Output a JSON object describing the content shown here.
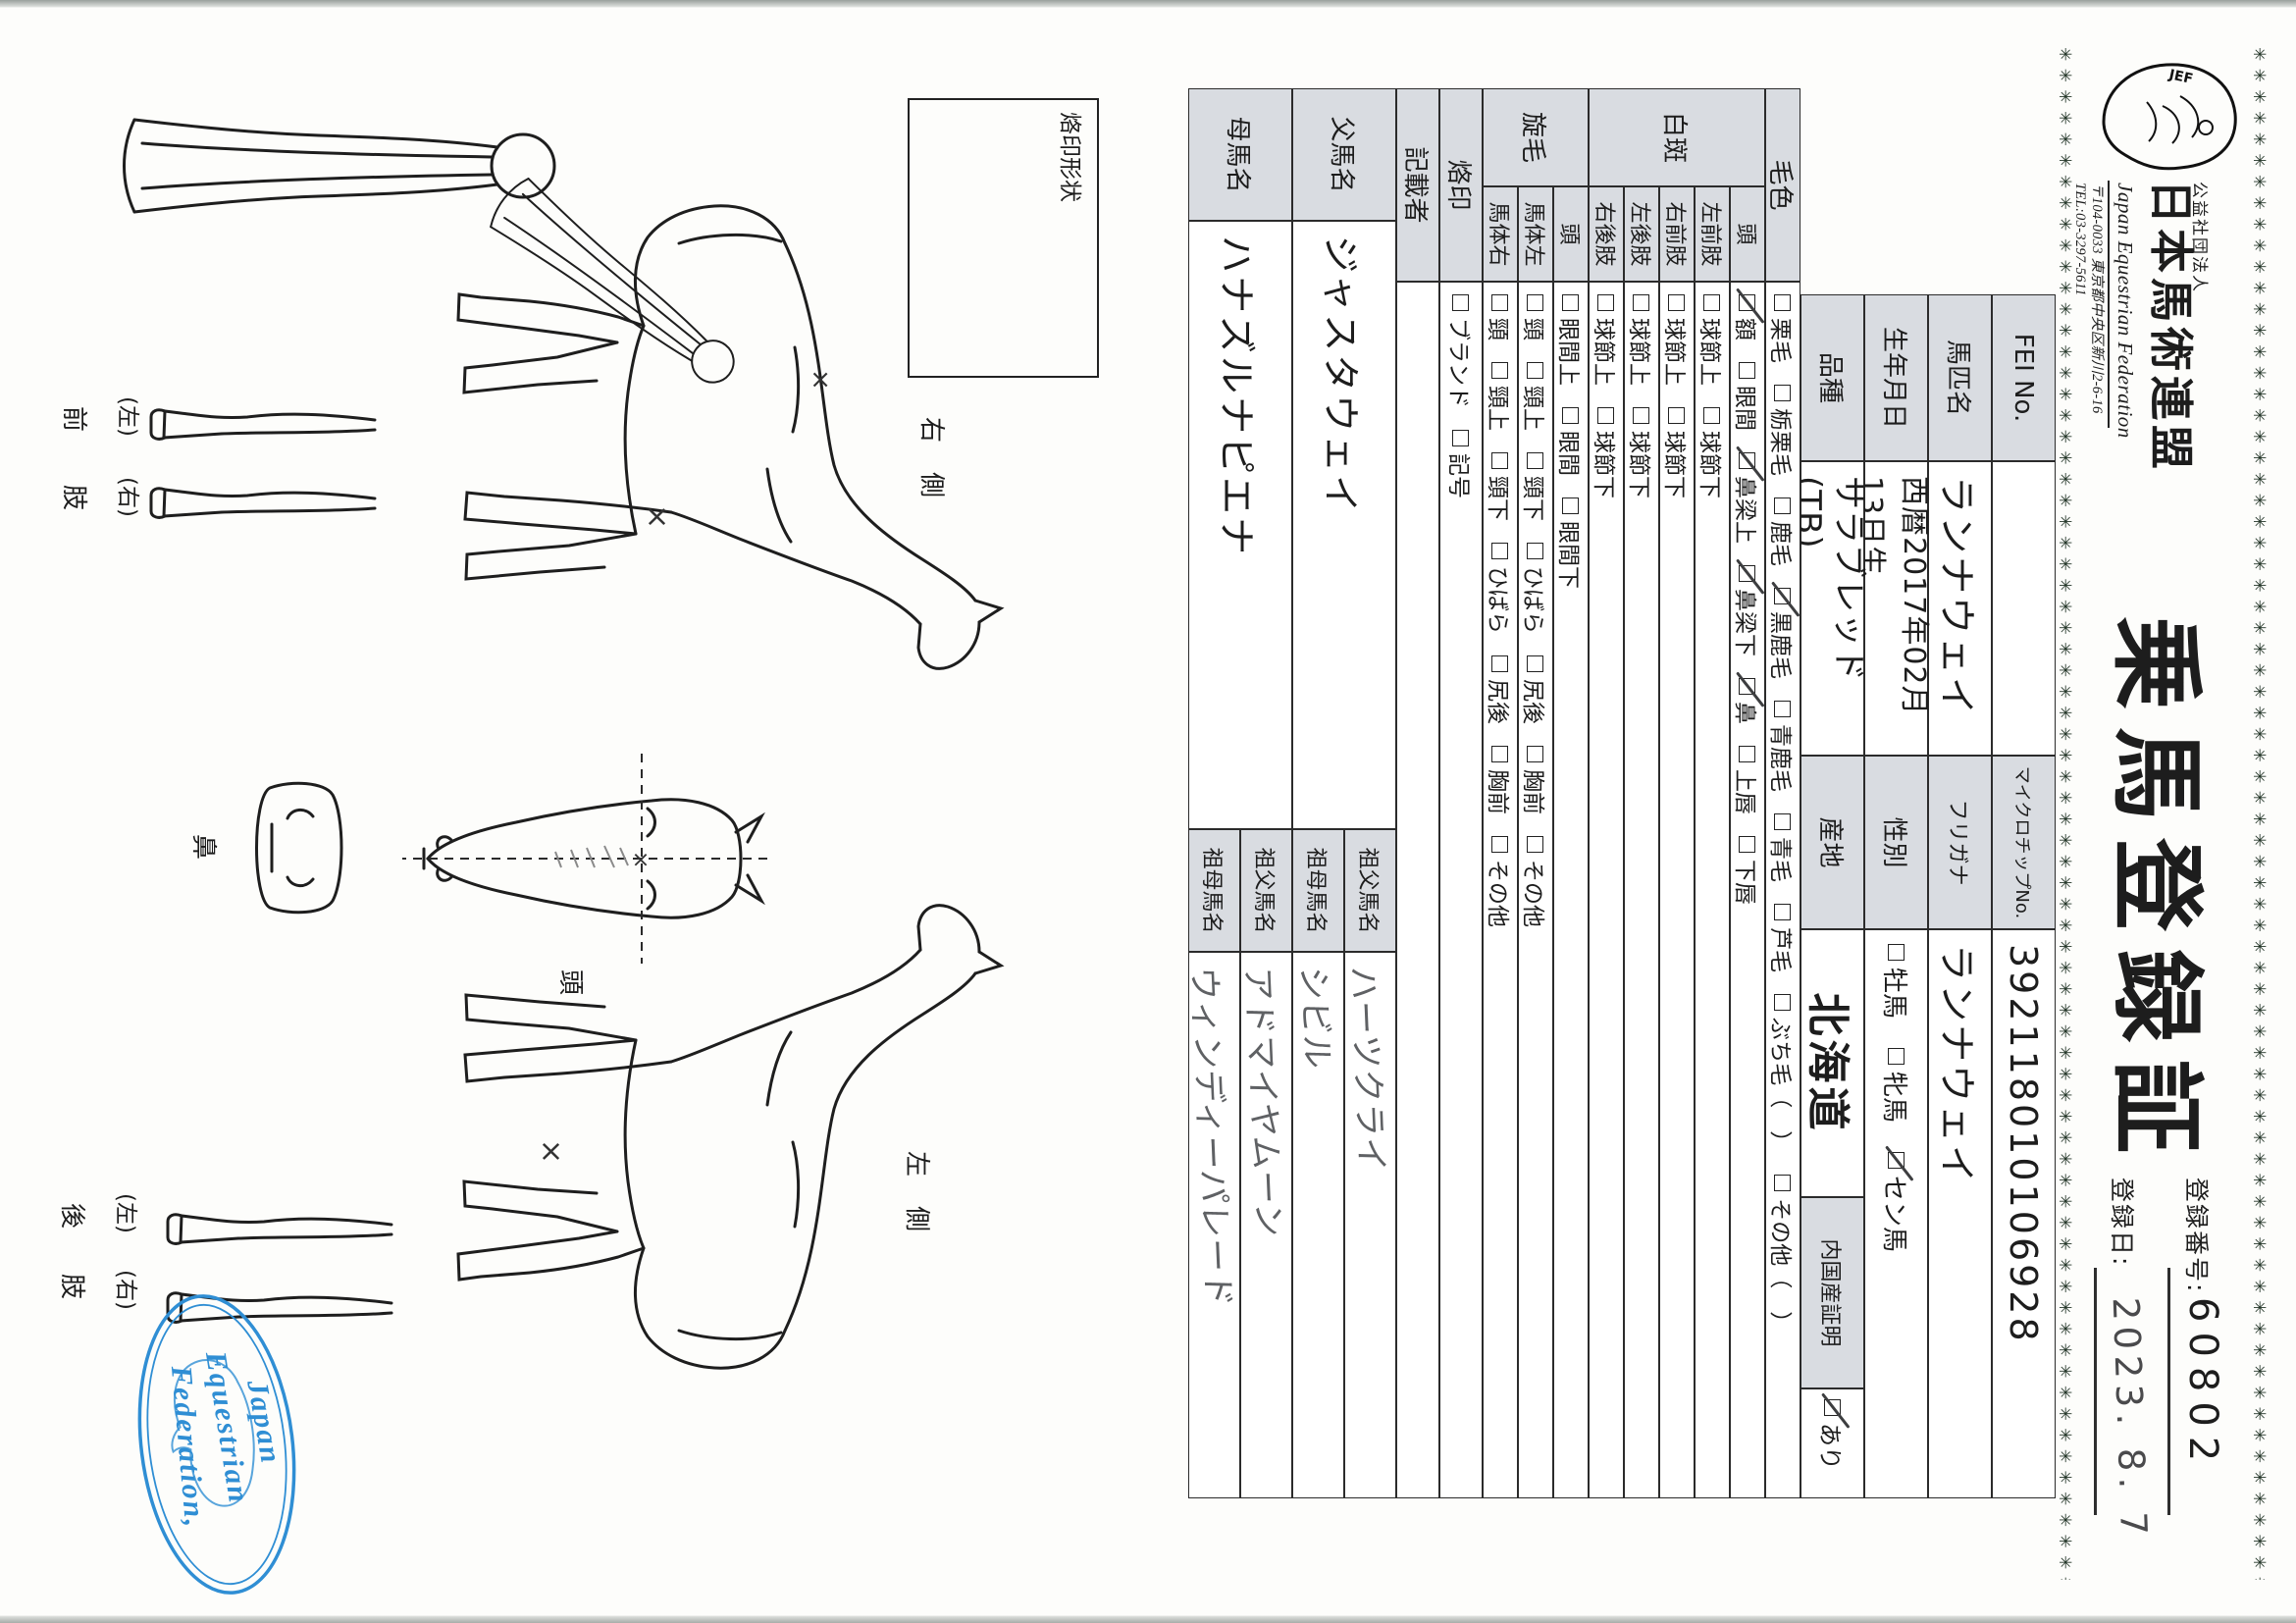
{
  "header": {
    "border_char": "✳",
    "logo_text": "JEF",
    "org_small": "公益社団法人",
    "org_large": "日本馬術連盟",
    "org_en": "Japan Equestrian Federation",
    "address": "〒104-0033 東京都中央区新川2-6-16",
    "tel": "TEL:03-3297-5611",
    "title": "乗馬登録証",
    "reg_no_label": "登録番号:",
    "reg_no_value": "60802",
    "reg_date_label": "登録日:",
    "reg_date_value": "2023. 8. 7"
  },
  "table": {
    "fei": {
      "label": "FEI No.",
      "value": ""
    },
    "name": {
      "label": "馬匹名",
      "value": "ランナウェイ"
    },
    "birth": {
      "label": "生年月日",
      "value": "西暦2017年02月13日生"
    },
    "breed": {
      "label": "品種",
      "value": "サラブレッド(TB)"
    },
    "microchip": {
      "label": "マイクロチップNo.",
      "value": "392118010106928"
    },
    "furigana": {
      "label": "フリガナ",
      "value": "ランナウェイ"
    },
    "sex": {
      "label": "性別",
      "options": [
        {
          "label": "牡馬",
          "checked": false
        },
        {
          "label": "牝馬",
          "checked": false
        },
        {
          "label": "セン馬",
          "checked": true
        }
      ]
    },
    "origin": {
      "label": "産地",
      "value": "北海道"
    },
    "domestic": {
      "label": "内国産証明",
      "options": [
        {
          "label": "あり",
          "checked": true
        }
      ]
    },
    "coat": {
      "label": "毛色",
      "options": [
        {
          "label": "栗毛",
          "checked": false
        },
        {
          "label": "栃栗毛",
          "checked": false
        },
        {
          "label": "鹿毛",
          "checked": false
        },
        {
          "label": "黒鹿毛",
          "checked": true
        },
        {
          "label": "青鹿毛",
          "checked": false
        },
        {
          "label": "青毛",
          "checked": false
        },
        {
          "label": "芦毛",
          "checked": false
        },
        {
          "label": "ぶち毛（　）",
          "checked": false
        },
        {
          "label": "その他（　）",
          "checked": false
        }
      ]
    },
    "hakuhan": {
      "group_label": "白斑",
      "head": {
        "label": "頭",
        "options": [
          {
            "label": "額",
            "checked": true
          },
          {
            "label": "眼間",
            "checked": false
          },
          {
            "label": "鼻梁上",
            "checked": true
          },
          {
            "label": "鼻梁下",
            "checked": true
          },
          {
            "label": "鼻",
            "checked": true
          },
          {
            "label": "上唇",
            "checked": false
          },
          {
            "label": "下唇",
            "checked": false
          }
        ]
      },
      "legs": [
        {
          "label": "左前肢",
          "options": [
            {
              "label": "球節上",
              "checked": false
            },
            {
              "label": "球節下",
              "checked": false
            }
          ]
        },
        {
          "label": "右前肢",
          "options": [
            {
              "label": "球節上",
              "checked": false
            },
            {
              "label": "球節下",
              "checked": false
            }
          ]
        },
        {
          "label": "左後肢",
          "options": [
            {
              "label": "球節上",
              "checked": false
            },
            {
              "label": "球節下",
              "checked": false
            }
          ]
        },
        {
          "label": "右後肢",
          "options": [
            {
              "label": "球節上",
              "checked": false
            },
            {
              "label": "球節下",
              "checked": false
            }
          ]
        }
      ]
    },
    "senmou": {
      "group_label": "旋毛",
      "rows": [
        {
          "label": "頭",
          "options": [
            {
              "label": "眼間上",
              "checked": false
            },
            {
              "label": "眼間",
              "checked": false
            },
            {
              "label": "眼間下",
              "checked": false
            }
          ]
        },
        {
          "label": "馬体左",
          "options": [
            {
              "label": "頸",
              "checked": false
            },
            {
              "label": "頸上",
              "checked": false
            },
            {
              "label": "頸下",
              "checked": false
            },
            {
              "label": "ひばら",
              "checked": false
            },
            {
              "label": "尻後",
              "checked": false
            },
            {
              "label": "胸前",
              "checked": false
            },
            {
              "label": "その他",
              "checked": false
            }
          ]
        },
        {
          "label": "馬体右",
          "options": [
            {
              "label": "頸",
              "checked": false
            },
            {
              "label": "頸上",
              "checked": false
            },
            {
              "label": "頸下",
              "checked": false
            },
            {
              "label": "ひばら",
              "checked": false
            },
            {
              "label": "尻後",
              "checked": false
            },
            {
              "label": "胸前",
              "checked": false
            },
            {
              "label": "その他",
              "checked": false
            }
          ]
        }
      ]
    },
    "brand": {
      "label": "烙印",
      "options": [
        {
          "label": "ブランド",
          "checked": false
        },
        {
          "label": "記号",
          "checked": false
        }
      ]
    },
    "recorder": {
      "label": "記載者",
      "value": ""
    },
    "sire": {
      "label": "父馬名",
      "value": "ジャスタウェイ"
    },
    "dam": {
      "label": "母馬名",
      "value": "ハナズルナピエナ"
    },
    "sire_gf": {
      "label": "祖父馬名",
      "value": "ハーツクライ"
    },
    "sire_gm": {
      "label": "祖母馬名",
      "value": "シビル"
    },
    "dam_gf": {
      "label": "祖父馬名",
      "value": "アドマイヤムーン"
    },
    "dam_gm": {
      "label": "祖母馬名",
      "value": "ウィンディーパレード"
    }
  },
  "diagram": {
    "brand_box_label": "烙印形状",
    "right_side_1": "右",
    "right_side_2": "側",
    "left_side_1": "左",
    "left_side_2": "側",
    "head_label": "頭",
    "nose_label": "鼻",
    "fore_left": "(左)",
    "fore_right": "(右)",
    "fore_1": "前",
    "fore_2": "肢",
    "hind_left": "(左)",
    "hind_right": "(右)",
    "hind_1": "後",
    "hind_2": "肢",
    "stamp_line_1": "Japan",
    "stamp_line_2": "Equestrian",
    "stamp_line_3": "Federation,"
  },
  "colors": {
    "label_cell_gray": "#d9dce1",
    "stamp_blue": "#2f8ed4",
    "table_line": "#2b2b2b",
    "pencil_gray": "#5f6164",
    "star_border_green": "#233528"
  }
}
